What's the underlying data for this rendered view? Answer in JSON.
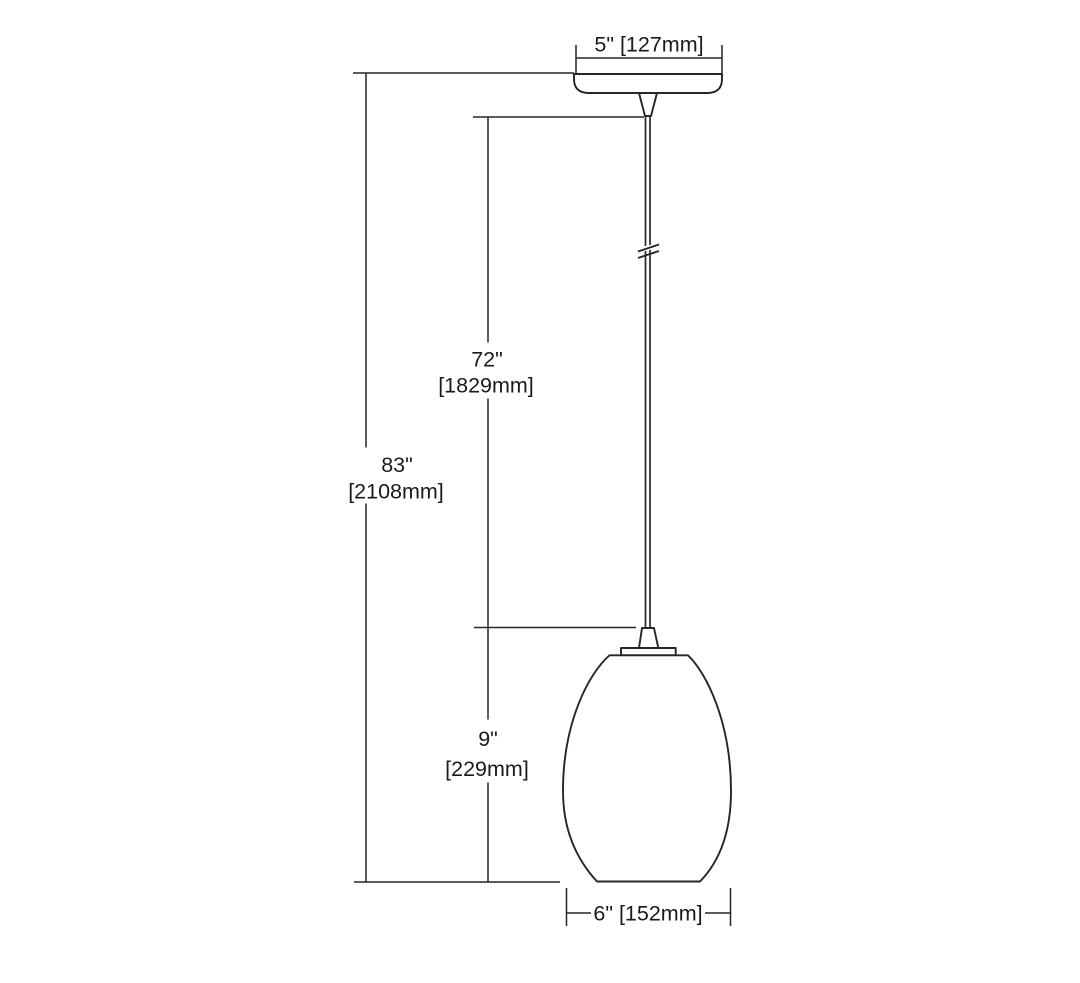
{
  "page": {
    "background": "#ffffff",
    "line_color": "#262626",
    "text_color": "#1a1a1a"
  },
  "diagram": {
    "type": "technical-dimension-drawing",
    "subject": "pendant light fixture with canopy, hanging cord and teardrop glass shade",
    "labels": {
      "canopy_width": "5\" [127mm]",
      "cord_drop_in": "72\"",
      "cord_drop_mm": "[1829mm]",
      "overall_height_in": "83\"",
      "overall_height_mm": "[2108mm]",
      "shade_height_in": "9\"",
      "shade_height_mm": "[229mm]",
      "shade_width": "6\" [152mm]"
    }
  }
}
